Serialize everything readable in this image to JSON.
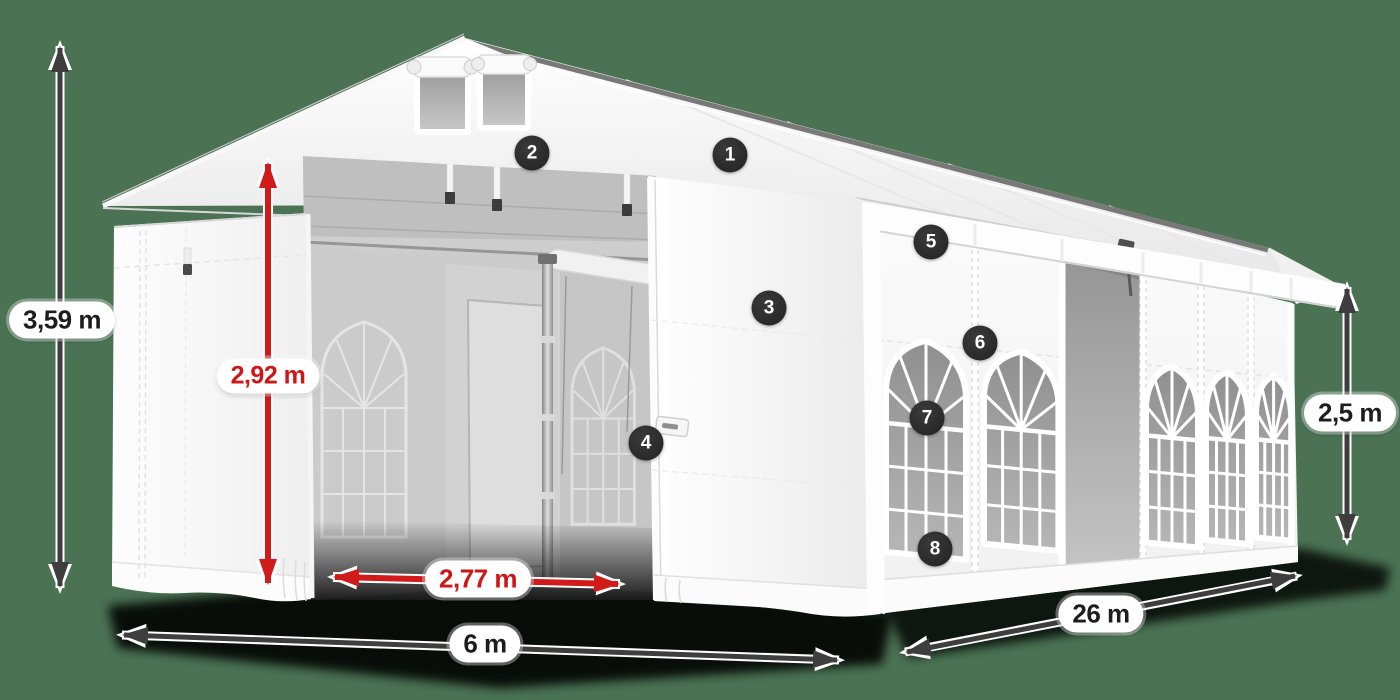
{
  "scene": {
    "subject": "White event marquee tent shown in perspective with dimension annotations",
    "background_color": "#4a7253"
  },
  "dimensions": {
    "total_height": {
      "value": "3,59 m",
      "style": "dark"
    },
    "inner_height": {
      "value": "2,92 m",
      "style": "red"
    },
    "door_width": {
      "value": "2,77 m",
      "style": "red"
    },
    "front_width": {
      "value": "6 m",
      "style": "dark"
    },
    "side_length": {
      "value": "26 m",
      "style": "dark"
    },
    "wall_height": {
      "value": "2,5 m",
      "style": "dark"
    }
  },
  "callouts": [
    {
      "number": "1"
    },
    {
      "number": "2"
    },
    {
      "number": "3"
    },
    {
      "number": "4"
    },
    {
      "number": "5"
    },
    {
      "number": "6"
    },
    {
      "number": "7"
    },
    {
      "number": "8"
    }
  ],
  "colors": {
    "arrow_dark": "#3e3e3e",
    "arrow_red": "#d11a1a",
    "callout_background": "#2b2b2b",
    "callout_text": "#ffffff",
    "label_background": "#ffffff",
    "label_text_dark": "#1d1d1d",
    "label_text_red": "#cf1616",
    "tent_white": "#f7f7f7",
    "interior_gray": "#bdbdbd"
  }
}
